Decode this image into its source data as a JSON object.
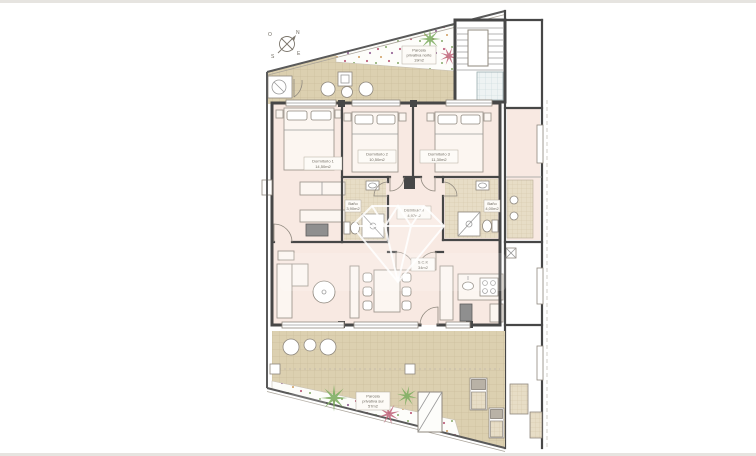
{
  "document": {
    "type": "apartment floor plan drawing"
  },
  "compass": {
    "north": "N",
    "south": "S",
    "east": "E",
    "west": "O"
  },
  "rooms": [
    {
      "name": "Dormitorio 1",
      "area": "14,50m2"
    },
    {
      "name": "Dormitorio 2",
      "area": "10,50m2"
    },
    {
      "name": "Dormitorio 3",
      "area": "11,30m2"
    },
    {
      "name": "Baño",
      "area": "3,90m2"
    },
    {
      "name": "Baño",
      "area": "4,00m2"
    },
    {
      "name": "Distribuidor",
      "area": "4,97m2"
    },
    {
      "name": "S.C.K",
      "area": "34m2"
    }
  ],
  "parcels": [
    {
      "line1": "Parcela",
      "line2": "privativa norte",
      "area": "19m2"
    },
    {
      "line1": "Parcela",
      "line2": "privativa sur",
      "area": "57m2"
    }
  ],
  "colors": {
    "room_fill": "#f8e9e2",
    "terrace_tile": "#dcd0b0",
    "tile_grout": "#cbbe9d",
    "bath_tile": "#e7ddc6",
    "blue_tile": "#eef3f3",
    "wall": "#474747",
    "palm_green": "#7fae63",
    "palm_red": "#c2697e",
    "label_text": "#6f6a60",
    "watermark": "#ffffff"
  }
}
